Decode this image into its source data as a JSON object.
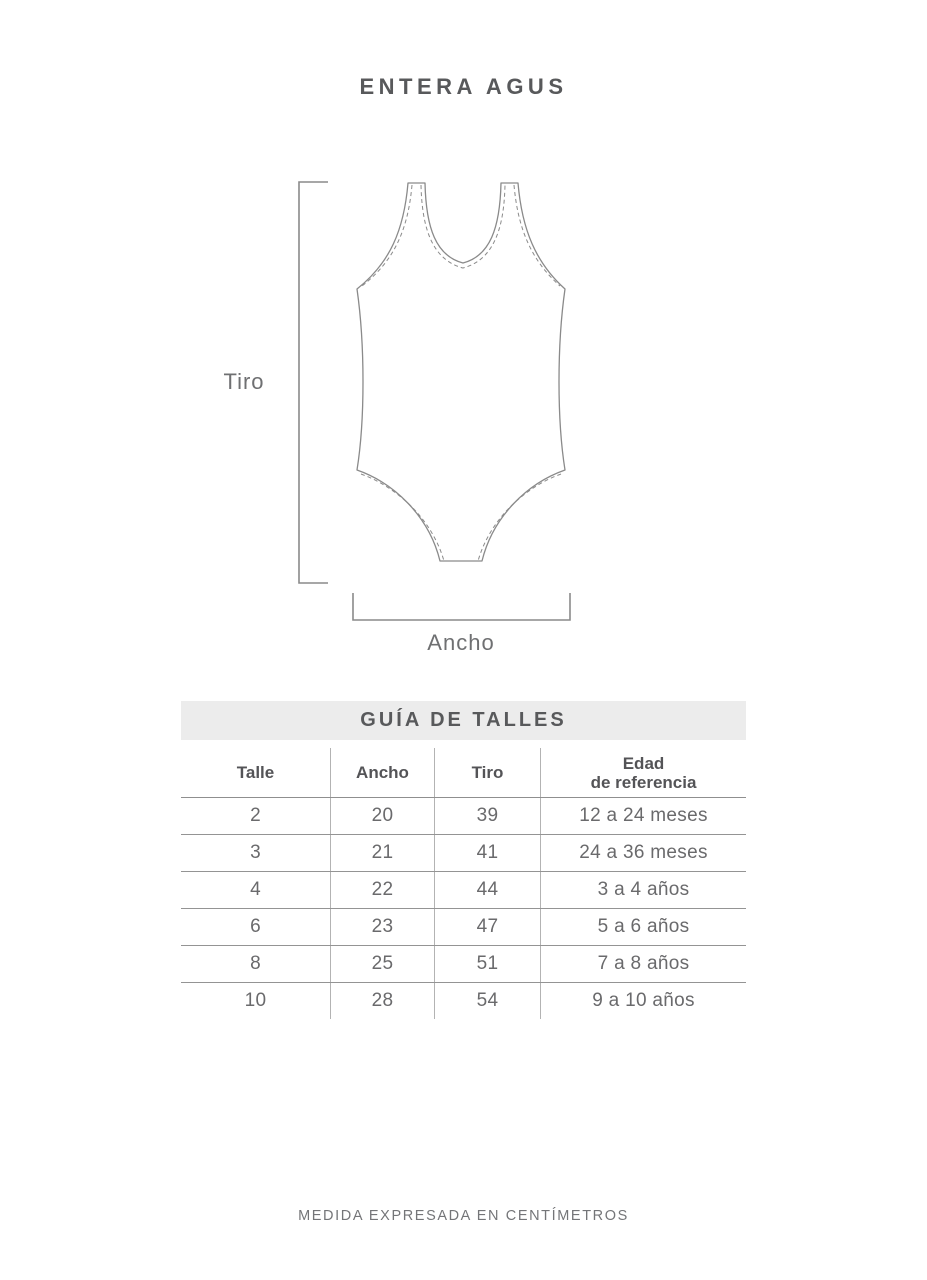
{
  "colors": {
    "banner_bg": "#ececec",
    "heading_text": "#58595b",
    "body_text": "#6a6a6c",
    "drawing_line": "#8a8a8a"
  },
  "header": {
    "title": "ENTERA AGUS"
  },
  "diagram": {
    "tiro_label": "Tiro",
    "ancho_label": "Ancho"
  },
  "size_guide": {
    "title": "GUÍA DE TALLES",
    "columns": [
      "Talle",
      "Ancho",
      "Tiro",
      "Edad"
    ],
    "column_edad_line2": "de referencia",
    "rows": [
      [
        "2",
        "20",
        "39",
        "12 a 24 meses"
      ],
      [
        "3",
        "21",
        "41",
        "24 a 36 meses"
      ],
      [
        "4",
        "22",
        "44",
        "3 a 4 años"
      ],
      [
        "6",
        "23",
        "47",
        "5 a 6 años"
      ],
      [
        "8",
        "25",
        "51",
        "7 a 8 años"
      ],
      [
        "10",
        "28",
        "54",
        "9 a 10 años"
      ]
    ]
  },
  "footer": {
    "note": "MEDIDA EXPRESADA EN CENTÍMETROS"
  }
}
